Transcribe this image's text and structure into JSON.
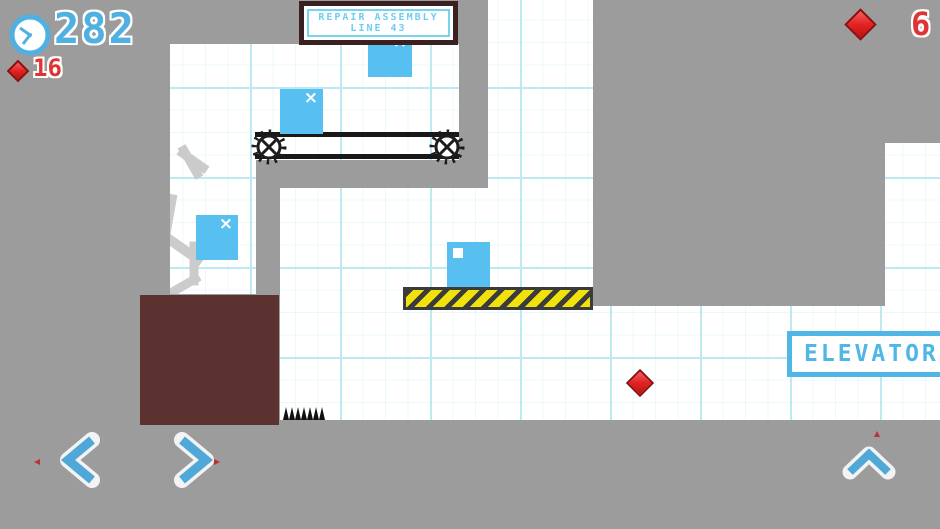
{
  "hud": {
    "timer_value": "282",
    "gem_count": "16",
    "gem_count_right": "6"
  },
  "signs": {
    "repair_line1": "REPAIR ASSEMBLY",
    "repair_line2": "LINE 43",
    "elevator_label": "ELEVATOR"
  },
  "entities": {
    "x_mark": "×"
  },
  "icons": {
    "clock": "clock-icon",
    "gem": "diamond-gem-icon",
    "left": "chevron-left-icon",
    "right": "chevron-right-icon",
    "up": "chevron-up-icon"
  },
  "colors": {
    "background_gray": "#9c9c9c",
    "paper_white": "#ffffff",
    "grid_major": "#bde9f2",
    "grid_minor": "#e9f8fb",
    "box_blue": "#58c0f0",
    "crate_maroon": "#5c3231",
    "hazard_dark": "#3b3b3b",
    "hazard_yellow": "#f0e20a",
    "gem_red": "#e32222",
    "hud_blue": "#4fb0e2",
    "hud_red": "#e03434",
    "sign_text_blue": "#6ecdf2",
    "sign_border_dark": "#3b2021",
    "elevator_blue": "#4fb6e6"
  }
}
